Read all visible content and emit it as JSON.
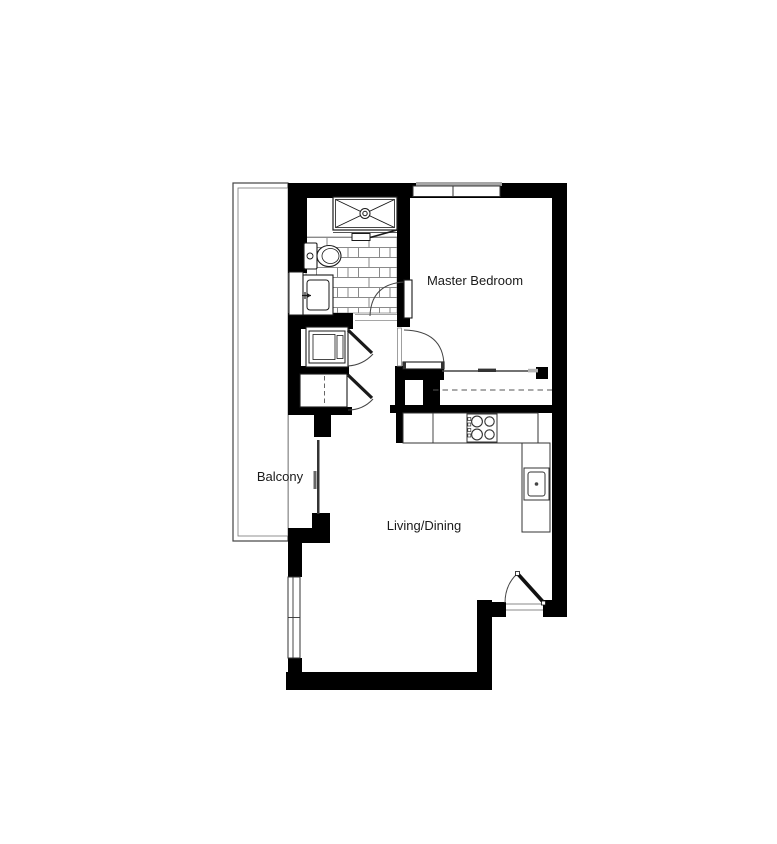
{
  "plan": {
    "type": "apartment-floor-plan",
    "rooms": {
      "master_bedroom": {
        "label": "Master Bedroom"
      },
      "balcony": {
        "label": "Balcony"
      },
      "living_dining": {
        "label": "Living/Dining"
      }
    },
    "fixtures": {
      "shower": "shower-with-drain",
      "shower_door": "shower-pivot-door",
      "toilet": "toilet",
      "vanity_sink": "bathroom-vanity-sink",
      "bathroom_floor": "tiled-floor",
      "washer_closet": "washer-dryer-closet",
      "linen_closet": "linen-closet-dashed",
      "bedroom_closet": "sliding-door-closet-with-rod",
      "cooktop": "four-burner-cooktop",
      "kitchen_sink": "kitchen-sink",
      "kitchen_counter": "l-shaped-counter",
      "entry_door": "entry-swing-door",
      "bathroom_door": "bathroom-swing-door",
      "bedroom_door": "bedroom-swing-door",
      "balcony_door": "balcony-sliding-door",
      "bedroom_window": "bedroom-window",
      "living_window": "living-room-window"
    },
    "colors": {
      "wall": "#000000",
      "fixture_line": "#1a1a1a",
      "thin_line": "#444444",
      "tile_line": "#8a8a8a",
      "sill": "#a6a6a6",
      "background": "#ffffff"
    }
  }
}
